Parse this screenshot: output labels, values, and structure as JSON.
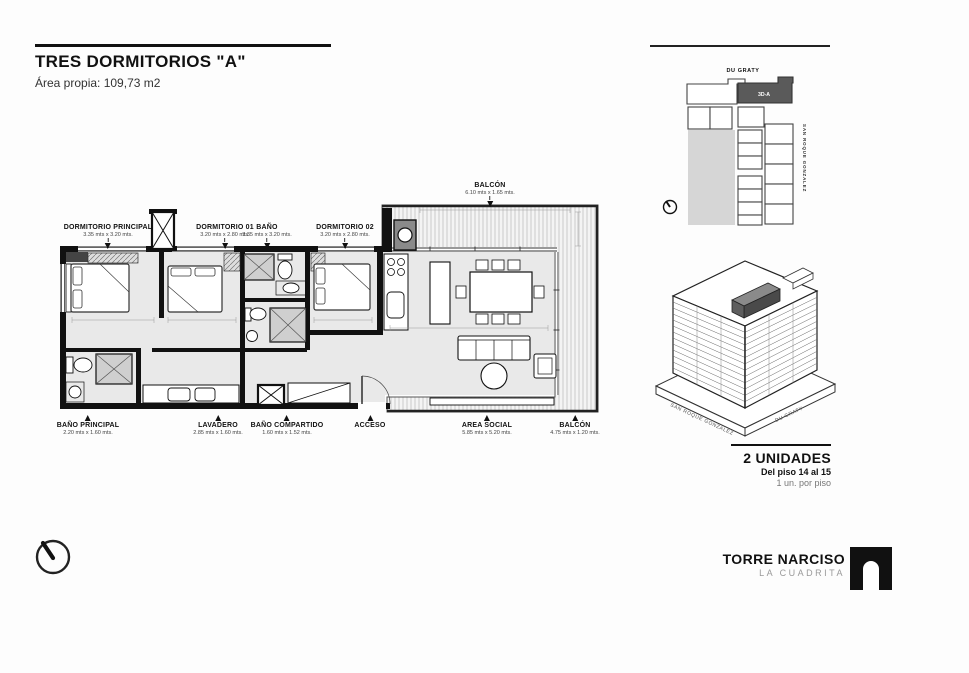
{
  "header": {
    "title": "TRES DORMITORIOS \"A\"",
    "subtitle": "Área propia: 109,73 m2"
  },
  "plan": {
    "rooms_top": [
      {
        "label": "DORMITORIO PRINCIPAL",
        "dims": "3.35 mts x 3.20 mts."
      },
      {
        "label": "DORMITORIO 01",
        "dims": "3.20 mts x 2.80 mts."
      },
      {
        "label": "BAÑO",
        "dims": "3.35 mts x 3.20 mts."
      },
      {
        "label": "DORMITORIO 02",
        "dims": "3.20 mts x 2.80 mts."
      }
    ],
    "balcony_top": {
      "label": "BALCÓN",
      "dims": "6.10 mts x 1.65 mts."
    },
    "rooms_bottom": [
      {
        "label": "BAÑO PRINCIPAL",
        "dims": "2.20 mts x 1.60 mts."
      },
      {
        "label": "LAVADERO",
        "dims": "2.85 mts x 1.60 mts."
      },
      {
        "label": "BAÑO COMPARTIDO",
        "dims": "1.60 mts x 1.52 mts."
      },
      {
        "label": "ACCESO",
        "dims": ""
      },
      {
        "label": "AREA SOCIAL",
        "dims": "5.85 mts x 5.20 mts."
      },
      {
        "label": "BALCÓN",
        "dims": "4.75 mts x 1.20 mts."
      }
    ]
  },
  "site_plan": {
    "street_top": "DU GRATY",
    "street_right": "SAN ROQUE GONZALEZ",
    "unit_label": "3D-A"
  },
  "axonometric": {
    "street_left": "SAN ROQUE GONZALEZ",
    "street_right": "DU GRATY"
  },
  "units_info": {
    "count": "2 UNIDADES",
    "floors": "Del piso 14 al 15",
    "per_floor": "1 un. por piso"
  },
  "brand": {
    "name": "TORRE NARCISO",
    "sub": "LA CUADRITA"
  },
  "colors": {
    "wall": "#111111",
    "interior_fill": "#e9e9e9",
    "highlight_unit": "#5a5a5a",
    "courtyard": "#d6d6d6"
  }
}
